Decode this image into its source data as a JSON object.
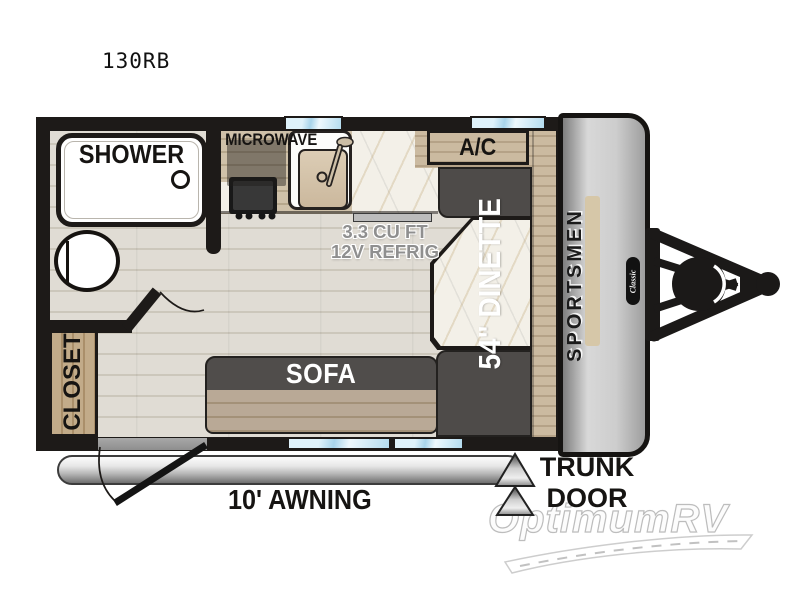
{
  "model": "130RB",
  "brand": {
    "name": "SPORTSMEN",
    "badge": "Classic"
  },
  "rooms": {
    "shower": "SHOWER",
    "closet": "CLOSET",
    "sofa": "SOFA",
    "dinette": "54\" DINETTE",
    "ac": "A/C",
    "microwave": "MICROWAVE",
    "refrig": {
      "line1": "3.3 CU FT",
      "line2": "12V REFRIG"
    }
  },
  "exterior": {
    "awning": "10' AWNING",
    "trunk": {
      "line1": "TRUNK",
      "line2": "DOOR"
    }
  },
  "watermark": "OptimumRV",
  "colors": {
    "wall": "#1d1a18",
    "floor": "#dedad2",
    "counter_wood": "#c3b294",
    "marble": "#f3f0e8",
    "bench_gray": "#4e4b49",
    "sofa_seat": "#b3a392",
    "closet_wood": "#b89e7c",
    "window_blue": "#bfe2f1",
    "front_cap_gray": "#c9c9c9",
    "awning_silver": "#c0c0c0",
    "refrig_text": "#8f8f8f"
  }
}
